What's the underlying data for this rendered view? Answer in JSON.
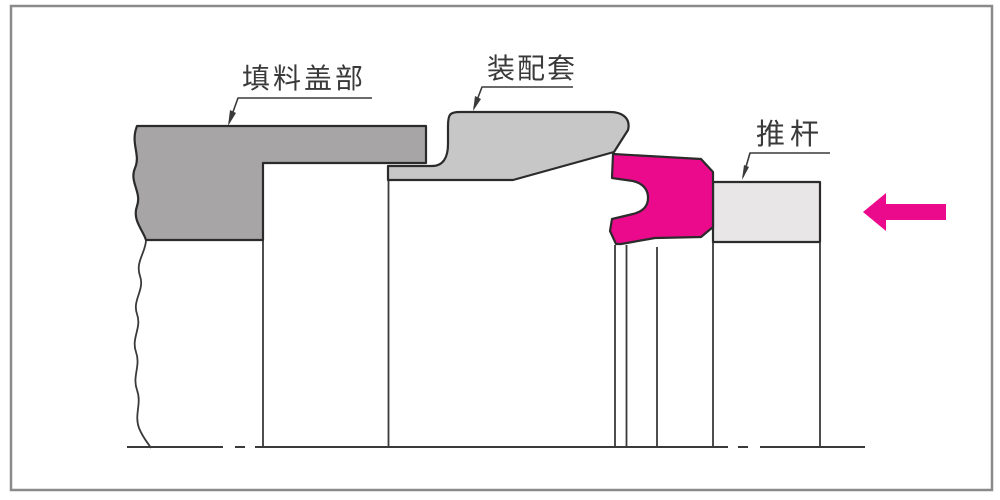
{
  "diagram": {
    "type": "engineering-cross-section",
    "labels": {
      "packing_cover": "填料盖部",
      "assembly_sleeve": "装配套",
      "push_rod": "推杆"
    },
    "colors": {
      "packing_cover": "#a7a5a6",
      "assembly_sleeve": "#c8c7c7",
      "push_rod": "#e8e6e7",
      "seal": "#eb0a8c",
      "push_arrow": "#eb0a8c",
      "outline": "#2b2b2b",
      "frame": "#8a8a8a",
      "label_text": "#3a3a3a"
    },
    "push_arrow": {
      "direction": "left"
    }
  }
}
